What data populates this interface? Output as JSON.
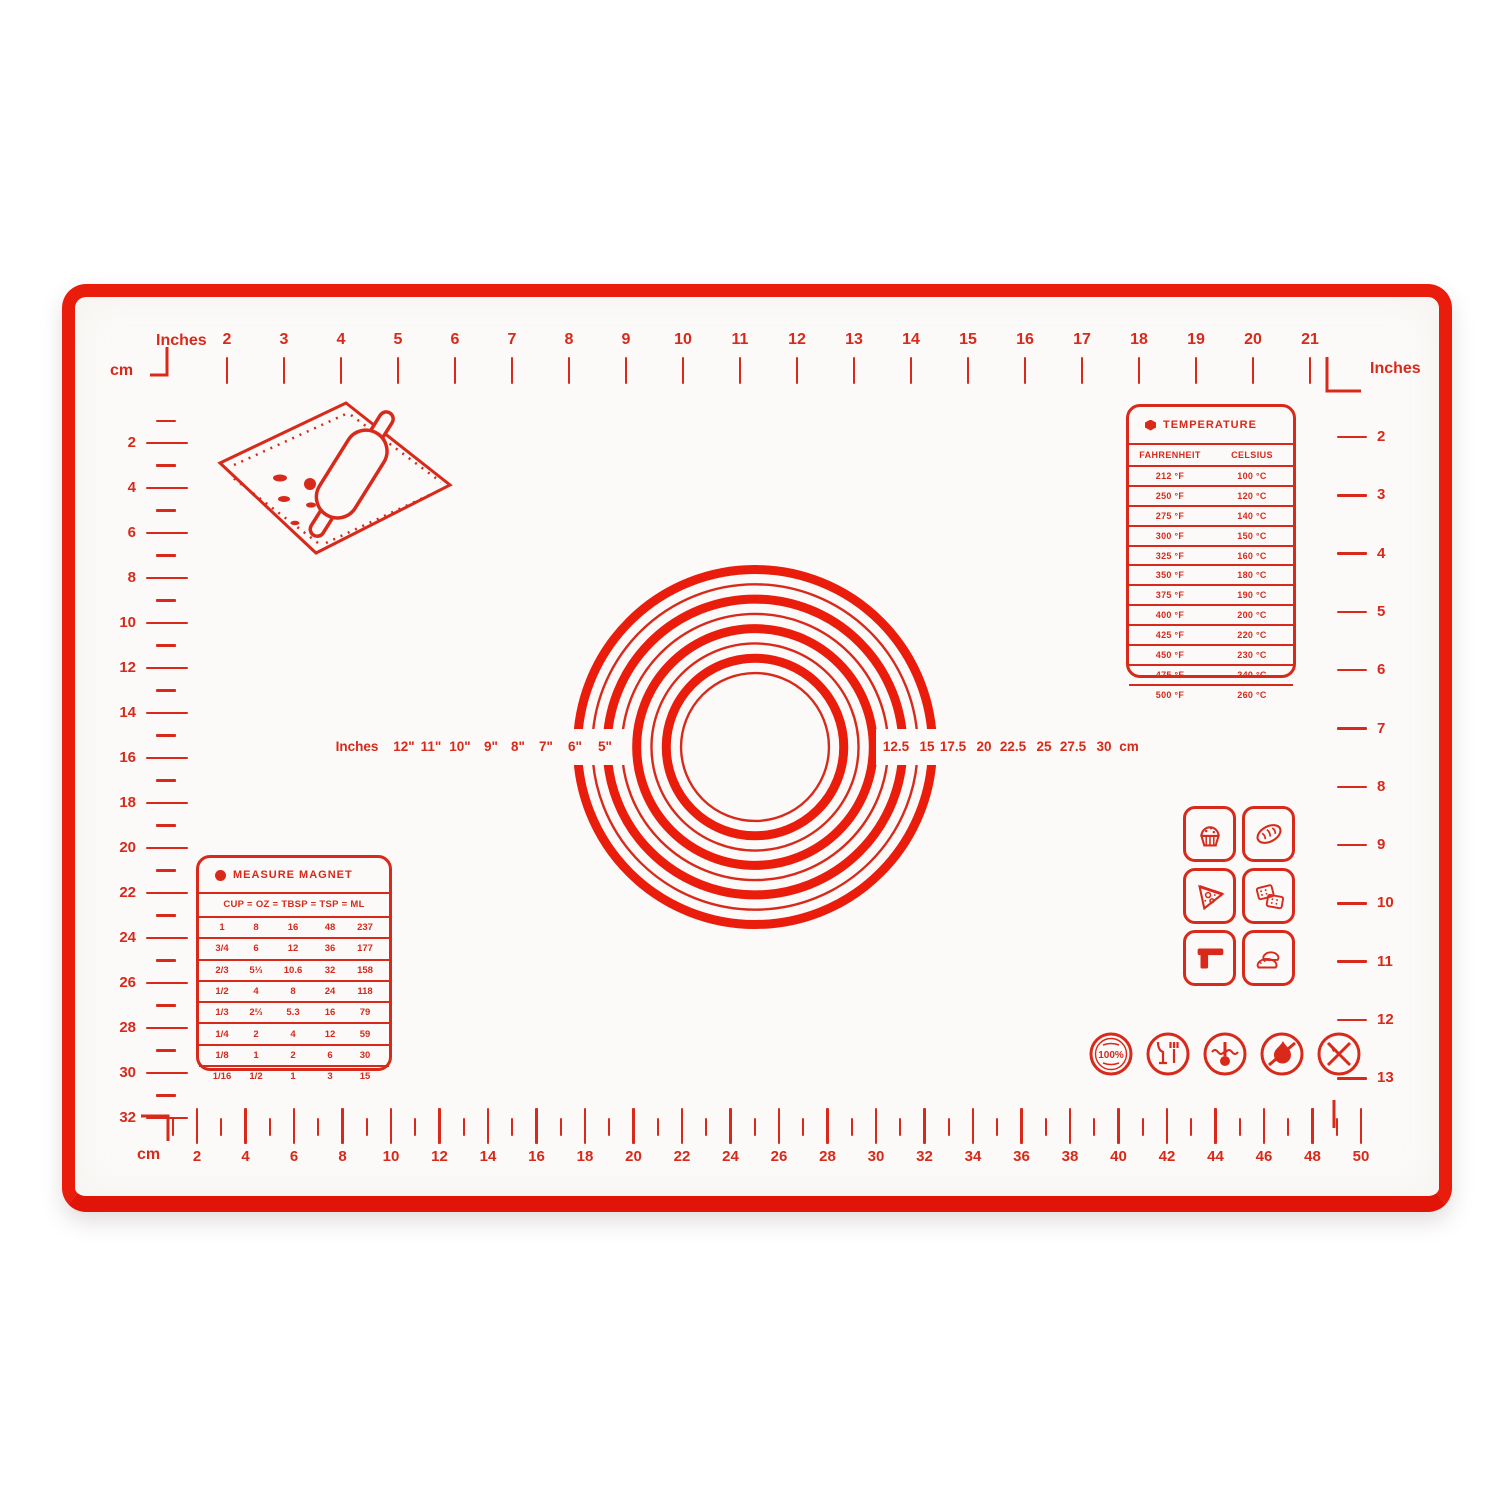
{
  "colors": {
    "print_red": "#d8291b",
    "border_red": "#ea1c0c",
    "mat_background": "#fbfaf8",
    "page_background": "#ffffff"
  },
  "rulers": {
    "top": {
      "unit_label": "Inches",
      "numbers": [
        "2",
        "3",
        "4",
        "5",
        "6",
        "7",
        "8",
        "9",
        "10",
        "11",
        "12",
        "13",
        "14",
        "15",
        "16",
        "17",
        "18",
        "19",
        "20",
        "21"
      ]
    },
    "left": {
      "unit_label_top": "cm",
      "unit_label_bottom": "cm",
      "numbers": [
        "2",
        "4",
        "6",
        "8",
        "10",
        "12",
        "14",
        "16",
        "18",
        "20",
        "22",
        "24",
        "26",
        "28",
        "30",
        "32"
      ]
    },
    "right": {
      "unit_label": "Inches",
      "numbers": [
        "2",
        "3",
        "4",
        "5",
        "6",
        "7",
        "8",
        "9",
        "10",
        "11",
        "12",
        "13"
      ]
    },
    "bottom": {
      "unit_label": "cm",
      "numbers": [
        "2",
        "4",
        "6",
        "8",
        "10",
        "12",
        "14",
        "16",
        "18",
        "20",
        "22",
        "24",
        "26",
        "28",
        "30",
        "32",
        "34",
        "36",
        "38",
        "40",
        "42",
        "44",
        "46",
        "48",
        "50"
      ]
    }
  },
  "circles": {
    "left_unit_label": "Inches",
    "right_unit_label": "cm",
    "inch_labels": [
      "12\"",
      "11\"",
      "10\"",
      "9\"",
      "8\"",
      "7\"",
      "6\"",
      "5\""
    ],
    "cm_labels": [
      "12.5",
      "15",
      "17.5",
      "20",
      "22.5",
      "25",
      "27.5",
      "30"
    ],
    "diameters_inches": [
      12,
      11,
      10,
      9,
      8,
      7,
      6,
      5
    ]
  },
  "temperature_table": {
    "title": "TEMPERATURE",
    "columns": [
      "FAHRENHEIT",
      "CELSIUS"
    ],
    "rows": [
      [
        "212 °F",
        "100 °C"
      ],
      [
        "250 °F",
        "120 °C"
      ],
      [
        "275 °F",
        "140 °C"
      ],
      [
        "300 °F",
        "150 °C"
      ],
      [
        "325 °F",
        "160 °C"
      ],
      [
        "350 °F",
        "180 °C"
      ],
      [
        "375 °F",
        "190 °C"
      ],
      [
        "400 °F",
        "200 °C"
      ],
      [
        "425 °F",
        "220 °C"
      ],
      [
        "450 °F",
        "230 °C"
      ],
      [
        "475 °F",
        "240 °C"
      ],
      [
        "500 °F",
        "260 °C"
      ]
    ]
  },
  "measure_table": {
    "title": "MEASURE MAGNET",
    "header": "CUP = OZ = TBSP = TSP = ML",
    "rows": [
      [
        "1",
        "8",
        "16",
        "48",
        "237"
      ],
      [
        "3/4",
        "6",
        "12",
        "36",
        "177"
      ],
      [
        "2/3",
        "5⅓",
        "10.6",
        "32",
        "158"
      ],
      [
        "1/2",
        "4",
        "8",
        "24",
        "118"
      ],
      [
        "1/3",
        "2⅔",
        "5.3",
        "16",
        "79"
      ],
      [
        "1/4",
        "2",
        "4",
        "12",
        "59"
      ],
      [
        "1/8",
        "1",
        "2",
        "6",
        "30"
      ],
      [
        "1/16",
        "1/2",
        "1",
        "3",
        "15"
      ]
    ]
  },
  "food_icons": [
    "cupcake-icon",
    "bread-icon",
    "pizza-icon",
    "crackers-icon",
    "dough-scraper-icon",
    "dumplings-icon"
  ],
  "badges": {
    "names": [
      "100-percent-silicone-badge",
      "food-safe-badge",
      "heat-resistant-badge",
      "no-open-flame-badge",
      "no-knife-badge"
    ],
    "silicone_badge_text": "100%"
  }
}
